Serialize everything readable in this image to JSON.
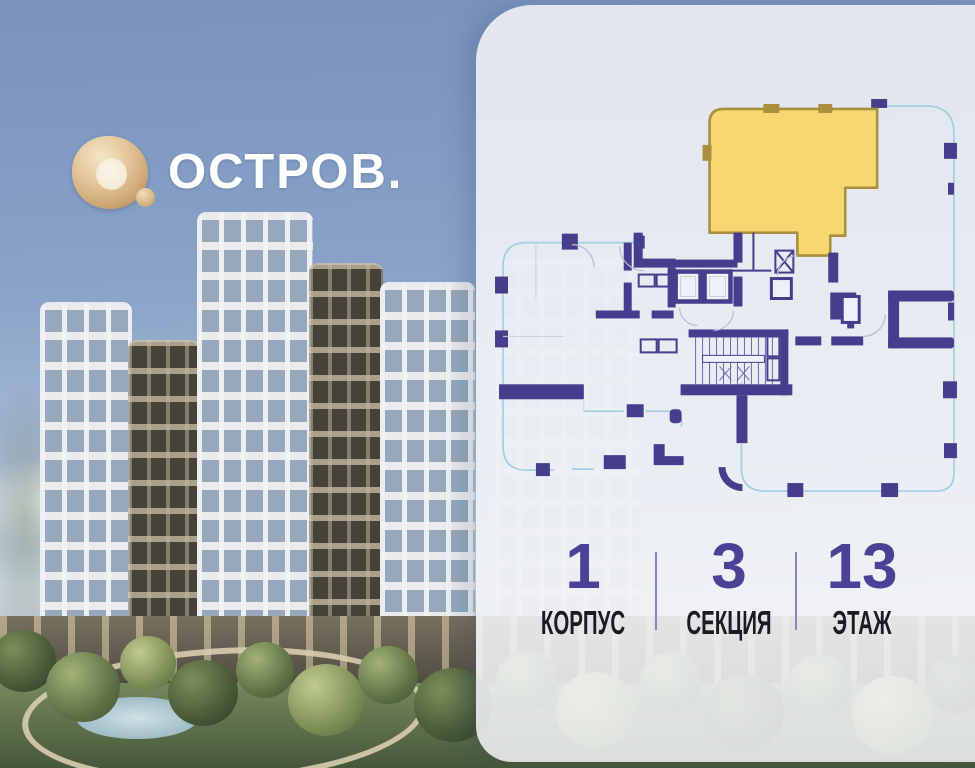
{
  "brand": {
    "name": "ОСТРОВ."
  },
  "panel": {
    "floorplan": {
      "selected_apartment": "highlighted-unit-top-right",
      "building_outline": "section-floor-plan"
    },
    "stats": {
      "items": [
        {
          "value": "1",
          "label": "КОРПУС"
        },
        {
          "value": "3",
          "label": "СЕКЦИЯ"
        },
        {
          "value": "13",
          "label": "ЭТАЖ"
        }
      ]
    }
  },
  "theme": {
    "accent": "#4b4297",
    "highlight": "#f8d771",
    "highlight-border": "#a98f3e",
    "wall": "#453e8c",
    "facade": "#a3cfe3",
    "gold": "#d9b788"
  }
}
